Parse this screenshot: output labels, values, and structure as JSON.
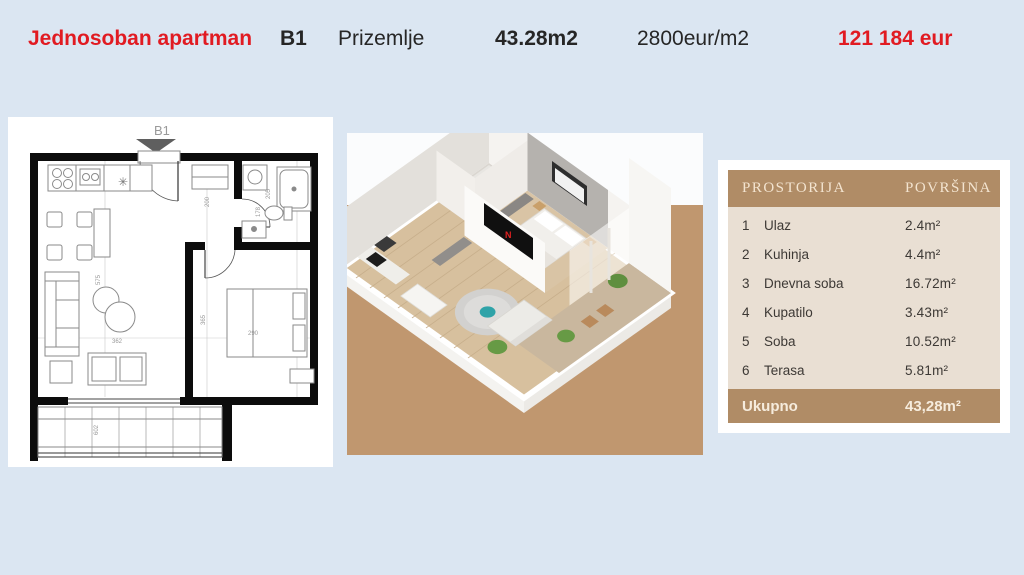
{
  "header": {
    "title": "Jednosoban apartman",
    "unit": "B1",
    "floor": "Prizemlje",
    "area": "43.28m2",
    "price_per_m2": "2800eur/m2",
    "total_price": "121 184 eur",
    "accent_red": "#e11b22"
  },
  "floorplan": {
    "label": "B1",
    "star_symbol": "✳",
    "dims": {
      "d200": "200",
      "d575": "575",
      "d362": "362",
      "d365": "365",
      "d290": "290",
      "d602": "602",
      "d205": "205",
      "d178": "178"
    }
  },
  "render3d": {
    "tv_label": "N",
    "backdrop_color": "#c0976f",
    "floor_color": "#d7c09e"
  },
  "rooms_table": {
    "col_room": "PROSTORIJA",
    "col_area": "POVRŠINA",
    "rows": [
      {
        "num": "1",
        "name": "Ulaz",
        "area": "2.4m²"
      },
      {
        "num": "2",
        "name": "Kuhinja",
        "area": "4.4m²"
      },
      {
        "num": "3",
        "name": "Dnevna soba",
        "area": "16.72m²"
      },
      {
        "num": "4",
        "name": "Kupatilo",
        "area": "3.43m²"
      },
      {
        "num": "5",
        "name": "Soba",
        "area": "10.52m²"
      },
      {
        "num": "6",
        "name": "Terasa",
        "area": "5.81m²"
      }
    ],
    "total_label": "Ukupno",
    "total_area": "43,28m²",
    "header_bg": "#b08c66",
    "body_bg": "#e9dfd3"
  }
}
